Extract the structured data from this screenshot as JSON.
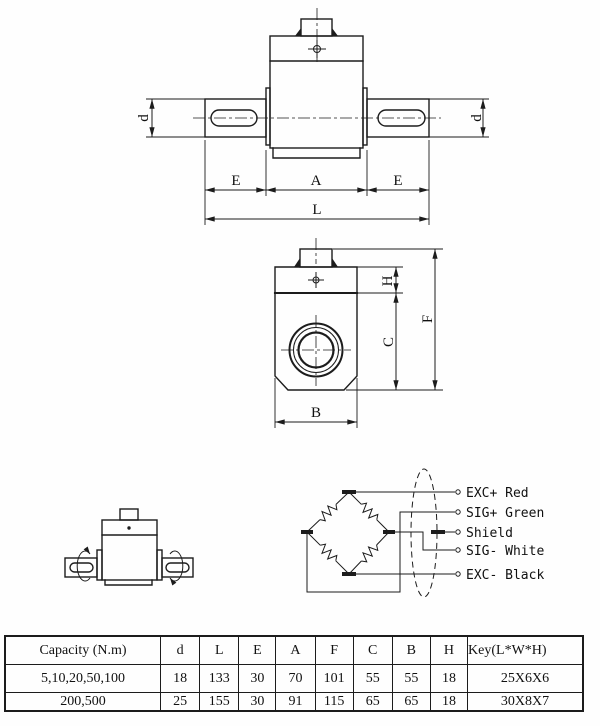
{
  "colors": {
    "line": "#1c1c1c",
    "background": "#fefefe"
  },
  "front_view": {
    "dim_d_left": "d",
    "dim_d_right": "d",
    "dim_e_left": "E",
    "dim_a": "A",
    "dim_e_right": "E",
    "dim_l": "L"
  },
  "side_view": {
    "dim_h": "H",
    "dim_f": "F",
    "dim_c": "C",
    "dim_b": "B"
  },
  "wiring": {
    "terminals": [
      {
        "label": "EXC+ Red"
      },
      {
        "label": "SIG+ Green"
      },
      {
        "label": "Shield"
      },
      {
        "label": "SIG- White"
      },
      {
        "label": "EXC- Black"
      }
    ]
  },
  "table": {
    "headers": [
      "Capacity (N.m)",
      "d",
      "L",
      "E",
      "A",
      "F",
      "C",
      "B",
      "H",
      "Key(L*W*H)"
    ],
    "rows": [
      [
        "5,10,20,50,100",
        "18",
        "133",
        "30",
        "70",
        "101",
        "55",
        "55",
        "18",
        "25X6X6"
      ],
      [
        "200,500",
        "25",
        "155",
        "30",
        "91",
        "115",
        "65",
        "65",
        "18",
        "30X8X7"
      ]
    ]
  }
}
